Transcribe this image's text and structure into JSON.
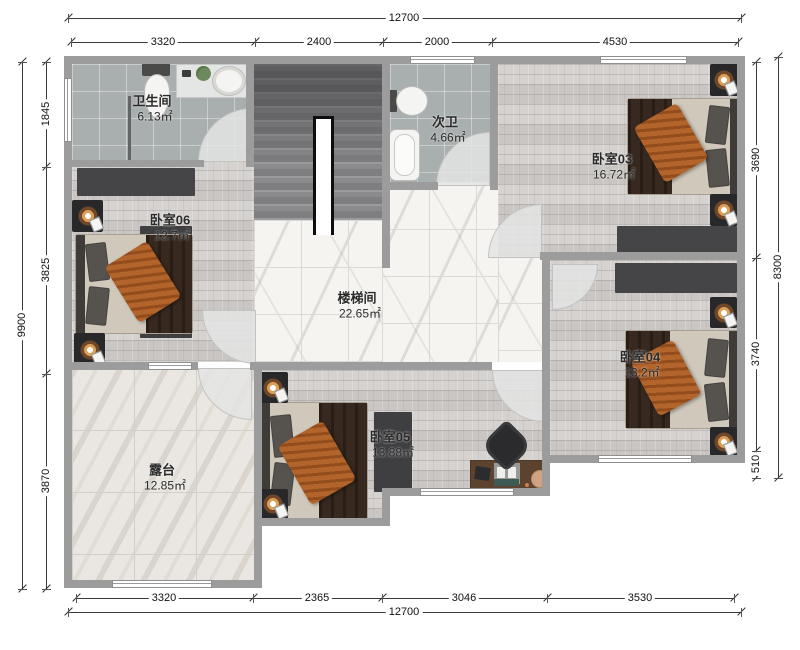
{
  "dims": {
    "top_total": "12700",
    "top_segments": [
      "3320",
      "2400",
      "2000",
      "4530"
    ],
    "bottom_segments": [
      "3320",
      "2365",
      "3046",
      "3530"
    ],
    "bottom_total": "12700",
    "left_total": "9900",
    "left_segments": [
      "1845",
      "3825",
      "3870"
    ],
    "right_segments": [
      "3690",
      "3740",
      "510"
    ],
    "right_total": "8300"
  },
  "rooms": {
    "bathroom": {
      "name": "卫生间",
      "area": "6.13㎡"
    },
    "guest_bath": {
      "name": "次卫",
      "area": "4.66㎡"
    },
    "bedroom03": {
      "name": "卧室03",
      "area": "16.72㎡"
    },
    "bedroom06": {
      "name": "卧室06",
      "area": "12.7㎡"
    },
    "stairwell": {
      "name": "楼梯间",
      "area": "22.65㎡"
    },
    "bedroom04": {
      "name": "卧室04",
      "area": "13.2㎡"
    },
    "bedroom05": {
      "name": "卧室05",
      "area": "13.88㎡"
    },
    "terrace": {
      "name": "露台",
      "area": "12.85㎡"
    }
  },
  "colors": {
    "wall": "#9c9c9c",
    "wood_floor": "#d2cecb",
    "tile_floor": "#a9aeae",
    "marble_floor": "#f5f4f1",
    "terrace_floor": "#eae7e2",
    "dark_furniture": "#454548",
    "blanket": "#37291f",
    "throw_blanket": "#ad5d26",
    "desk_wood": "#5b4330"
  }
}
